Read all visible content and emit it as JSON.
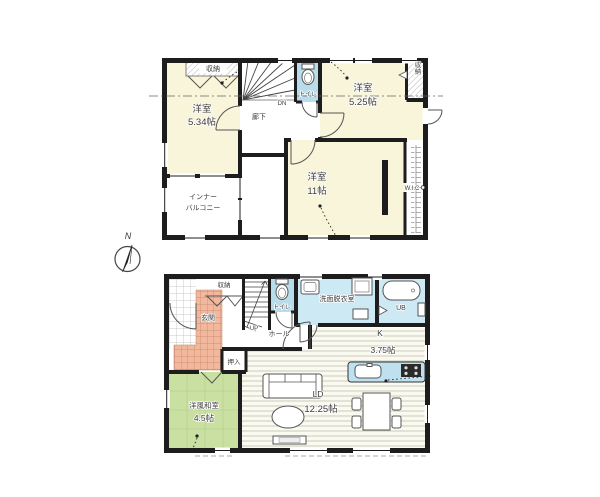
{
  "compass": {
    "north_label": "N"
  },
  "floor2": {
    "bedroom_a": {
      "name": "洋室",
      "size": "5.34帖"
    },
    "closet_a": {
      "label": "収納"
    },
    "stairs": {
      "label": "DN"
    },
    "corridor": {
      "label": "廊下"
    },
    "toilet": {
      "label": "トイレ"
    },
    "bedroom_b": {
      "name": "洋室",
      "size": "5.25帖"
    },
    "closet_b": {
      "label": "収納"
    },
    "bedroom_c": {
      "name": "洋室",
      "size": "11帖"
    },
    "wic": {
      "label": "W.I.C"
    },
    "balcony": {
      "line1": "インナー",
      "line2": "バルコニー"
    }
  },
  "floor1": {
    "closet": {
      "label": "収納"
    },
    "entrance": {
      "label": "玄関"
    },
    "stairs": {
      "label": "UP"
    },
    "toilet": {
      "label": "トイレ"
    },
    "washroom": {
      "label": "洗面脱衣室"
    },
    "bath": {
      "label": "UB"
    },
    "hall": {
      "label": "ホール"
    },
    "oshiire": {
      "label": "押入"
    },
    "kitchen": {
      "name": "K",
      "size": "3.75帖"
    },
    "living": {
      "name": "LD",
      "size": "12.25帖"
    },
    "tatami": {
      "name": "洋風和室",
      "size": "4.5帖"
    }
  },
  "colors": {
    "wall": "#1d1d1d",
    "room_cream": "#f9f5da",
    "toilet_blue": "#b9dcea",
    "bath_blue": "#cde9f3",
    "counter_blue": "#bfe1ef",
    "entrance_salmon": "#f2b89d",
    "tatami_green": "#cadfa2",
    "floor_stripe": "#c9c9bc"
  }
}
